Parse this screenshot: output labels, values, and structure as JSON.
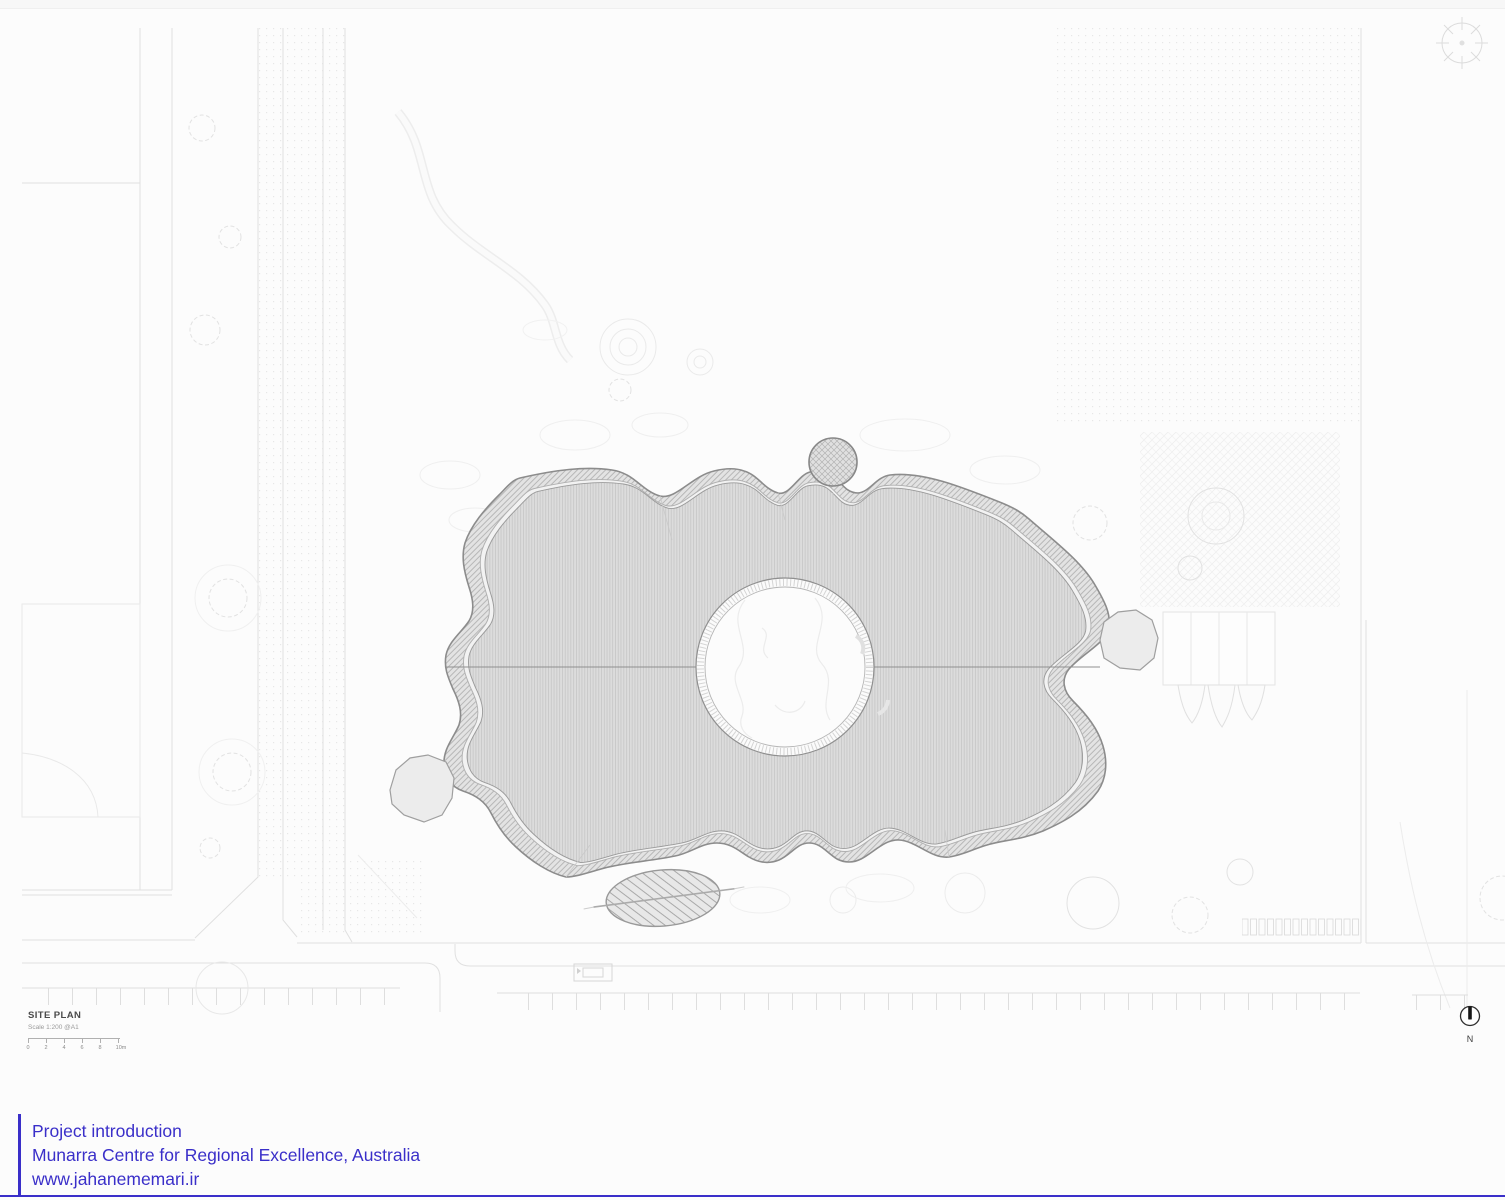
{
  "colors": {
    "accent_blue": "#3a2fc9",
    "page_bg": "#fcfcfc"
  },
  "title_block": {
    "title": "SITE PLAN",
    "scale_note": "Scale 1:200 @A1",
    "scale_bar_labels": [
      "0",
      "2",
      "4",
      "6",
      "8",
      "10m"
    ]
  },
  "north_indicator": {
    "label": "N",
    "icon": "north-arrow-icon"
  },
  "caption": {
    "heading": "Project introduction",
    "project": "Munarra Centre for Regional Excellence, Australia",
    "website": "www.jahanememari.ir"
  }
}
